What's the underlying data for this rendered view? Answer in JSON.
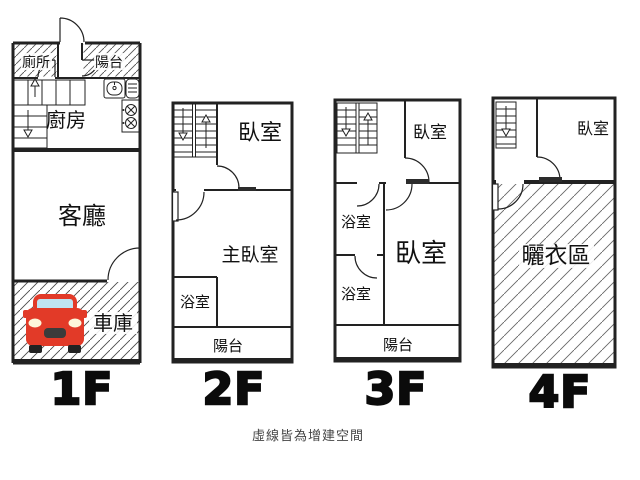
{
  "caption": "虛線皆為增建空間",
  "colors": {
    "wall": "#222222",
    "hatch_dense": "#555555",
    "hatch_garage": "#4a4a4a",
    "hatch_wide": "#666666",
    "car_body": "#e23a28",
    "car_window": "#bfe3f2",
    "car_grille": "#3b3b3b",
    "car_headlight": "#fdf6da",
    "floor_label": "#0b0b0b",
    "caption_text": "#444444"
  },
  "icons": {
    "stairs_up": "stairs-up-arrow",
    "stairs_down": "stairs-down-arrow",
    "sink": "kitchen-sink",
    "stove": "gas-stove-two-burners",
    "car": "red-car-front",
    "door": "door-swing-arc"
  },
  "floors": [
    {
      "id": "1F",
      "label": "1F",
      "rooms": {
        "toilet": "廁所",
        "balcony": "陽台",
        "kitchen": "廚房",
        "living_room": "客廳",
        "garage": "車庫"
      }
    },
    {
      "id": "2F",
      "label": "2F",
      "rooms": {
        "bedroom": "臥室",
        "master_bedroom": "主臥室",
        "bathroom": "浴室",
        "balcony": "陽台"
      }
    },
    {
      "id": "3F",
      "label": "3F",
      "rooms": {
        "bedroom_front": "臥室",
        "bathroom_upper": "浴室",
        "bedroom_main": "臥室",
        "bathroom_lower": "浴室",
        "balcony": "陽台"
      }
    },
    {
      "id": "4F",
      "label": "4F",
      "rooms": {
        "bedroom": "臥室",
        "drying_area": "曬衣區"
      }
    }
  ]
}
